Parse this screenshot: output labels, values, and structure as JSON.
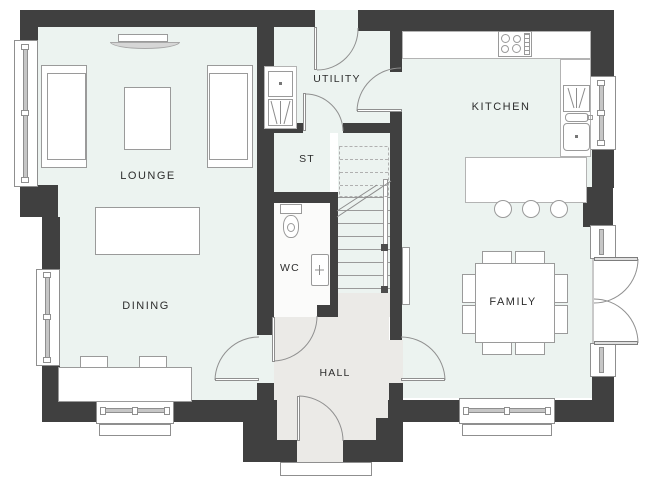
{
  "plan": {
    "type": "ground-floor-plan",
    "rooms": [
      {
        "id": "lounge",
        "label": "LOUNGE"
      },
      {
        "id": "dining",
        "label": "DINING"
      },
      {
        "id": "utility",
        "label": "UTILITY"
      },
      {
        "id": "store",
        "label": "ST"
      },
      {
        "id": "wc",
        "label": "WC"
      },
      {
        "id": "hall",
        "label": "HALL"
      },
      {
        "id": "kitchen",
        "label": "KITCHEN"
      },
      {
        "id": "family",
        "label": "FAMILY"
      }
    ],
    "colors": {
      "wall": "#404040",
      "floor": "#ecf3f0",
      "hall_floor": "#ebeae7",
      "wc_floor": "#fbfbfa",
      "outline": "#8f8f8f",
      "furniture_line": "#9a9a9a",
      "counter_line": "#b3b3b3",
      "label": "#2d2d2d",
      "canvas": "#ffffff"
    },
    "fixtures": [
      "fireplace",
      "sofa",
      "coffee-table",
      "console-table",
      "dining-table",
      "dining-chair",
      "utility-sink",
      "washing-machine",
      "toilet",
      "basin",
      "staircase",
      "handrail",
      "radiator",
      "hob",
      "kitchen-sink",
      "drainer",
      "breakfast-bar",
      "bar-stool",
      "family-table",
      "family-chair",
      "window",
      "door",
      "french-doors",
      "front-door",
      "porch-step"
    ]
  }
}
